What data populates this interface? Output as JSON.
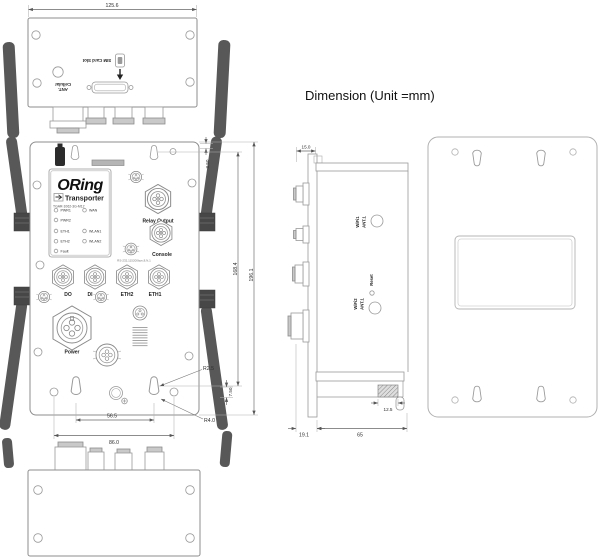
{
  "title": "Dimension (Unit =mm)",
  "top_view": {
    "width_dim": "125.6",
    "sim_label": "SIM Card Slot",
    "cellular_ant": {
      "line1": "Cellular",
      "line2": "ANT."
    }
  },
  "front_view": {
    "brand": "ORing",
    "series": "Transporter",
    "model": "TGAR-1062-3G-M12",
    "leds_left": [
      "PWR1",
      "PWR2",
      "ETH1",
      "ETH2",
      "Fault"
    ],
    "leds_right": [
      "WAN",
      "WLAN1",
      "WLAN2"
    ],
    "relay_label": "Relay Output",
    "console_label": "Console",
    "console_spec": "RS-232,115200bps,8,N,1",
    "ports": [
      "DO",
      "DI",
      "ETH2",
      "ETH1"
    ],
    "power_label": "Power",
    "dims": {
      "top_offset": "3.50",
      "keyhole_span_v": "168.4",
      "overall_height": "196.1",
      "bottom_offset": "7.50",
      "radius_small": "R2.5",
      "radius_large": "R4.0",
      "keyhole_span_h": "56.5",
      "mount_width": "86.0"
    }
  },
  "side_view": {
    "labels": {
      "wifi1": "WiFi1",
      "wifi1_ant": "ANT.1",
      "reset": "Reset",
      "wifi2": "WiFi2",
      "wifi2_ant": "ANT.1"
    },
    "dims": {
      "flange_depth": "15.0",
      "front_offset": "19.1",
      "body_depth": "65",
      "clip_width": "12.5"
    }
  }
}
